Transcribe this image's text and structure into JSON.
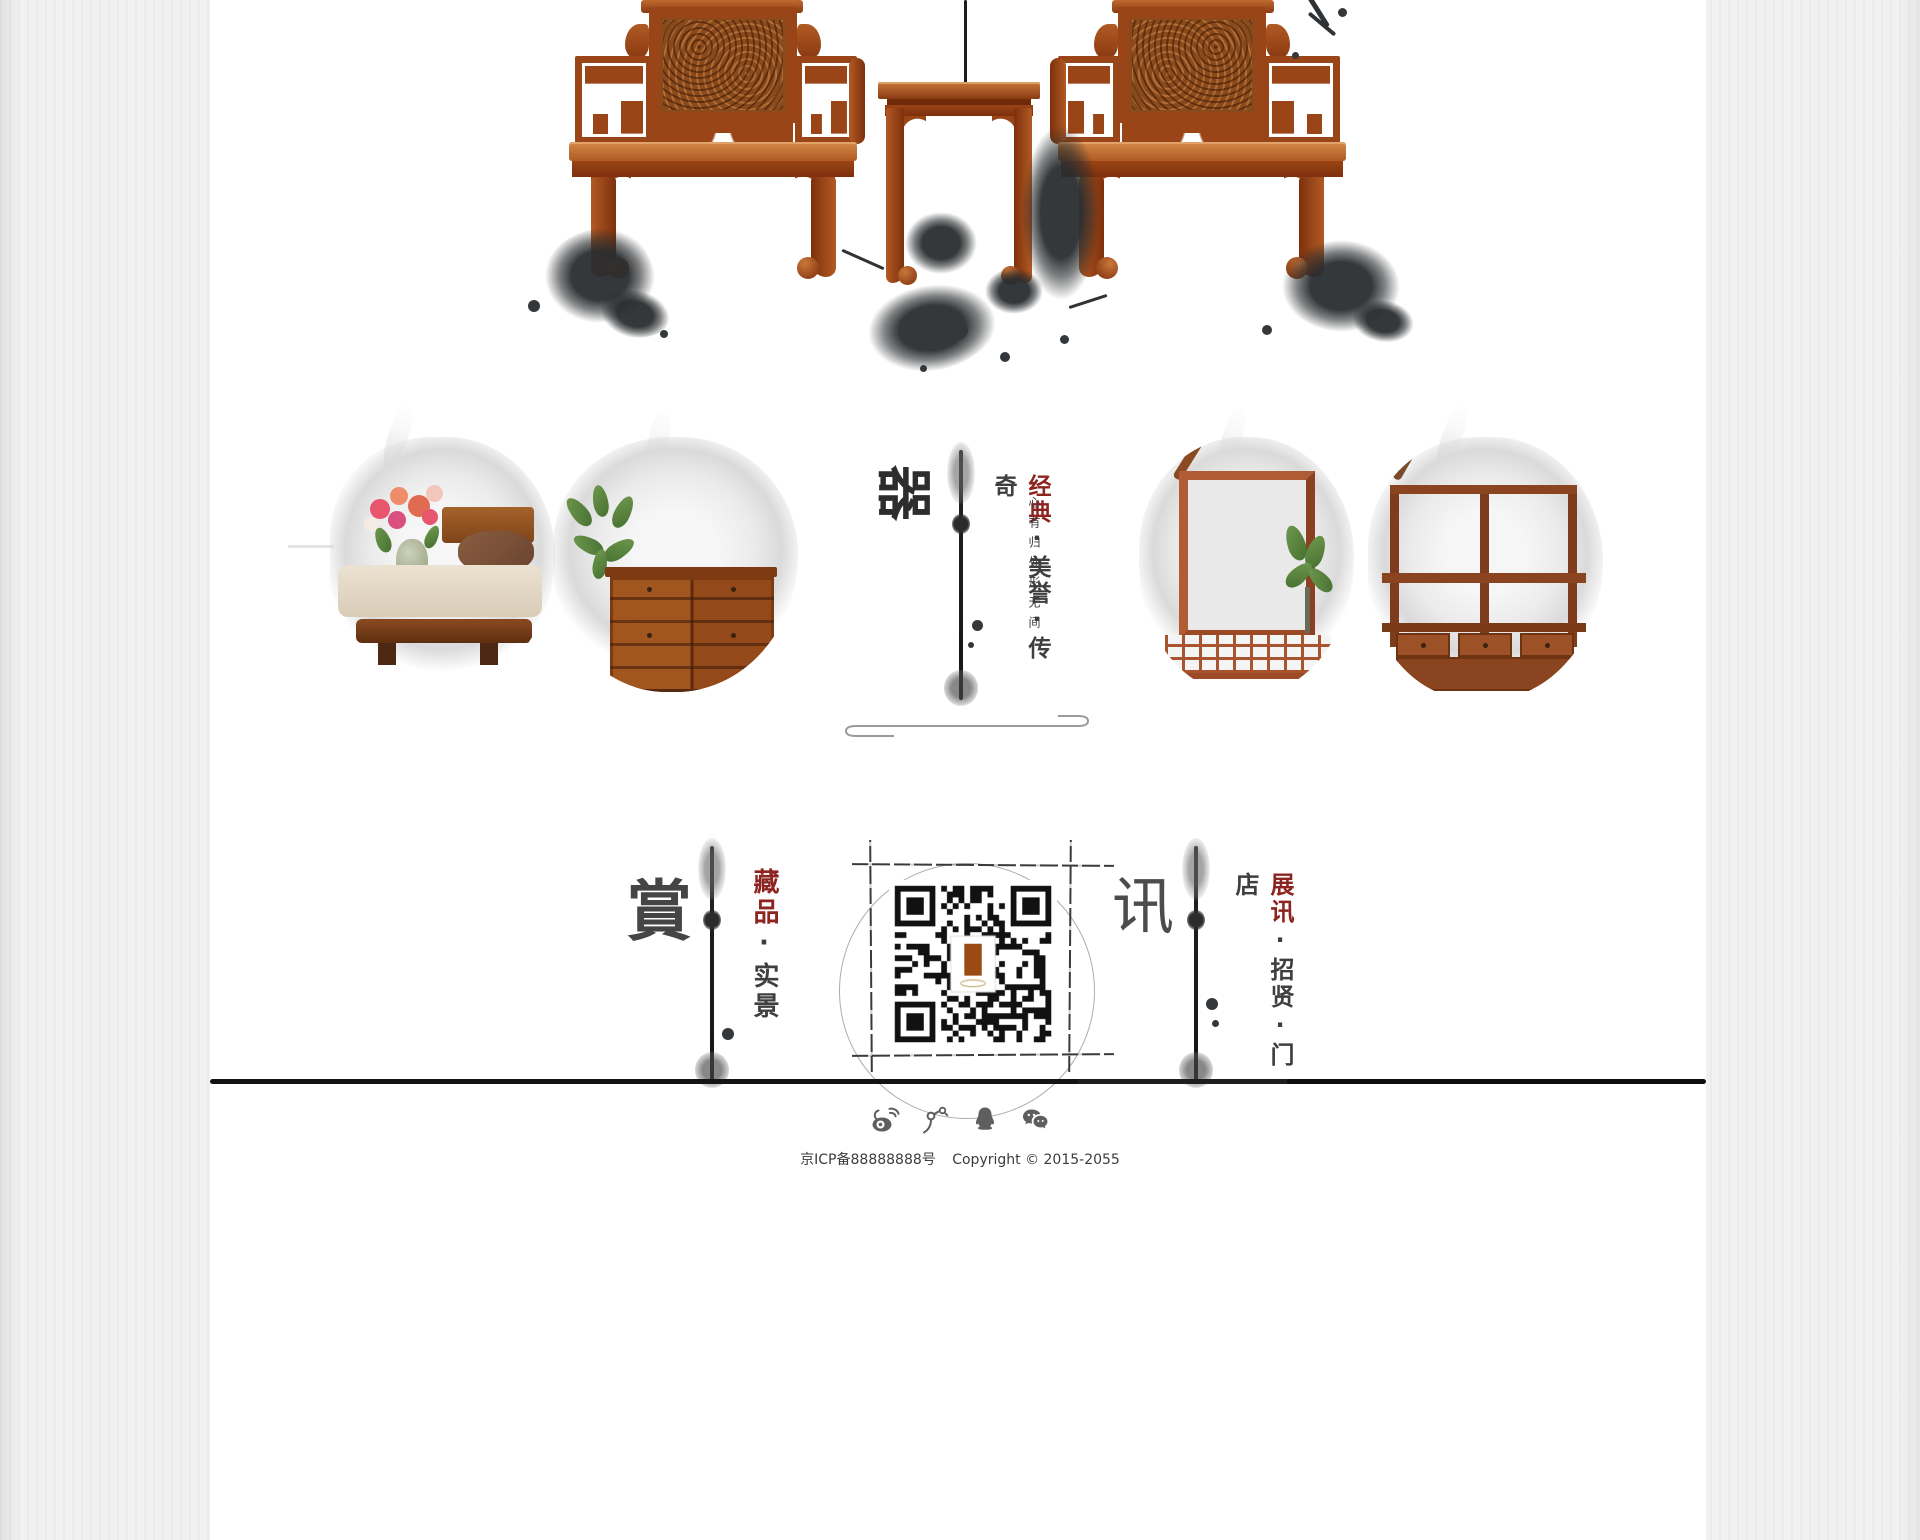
{
  "brand": {
    "mark_glyph": "器",
    "slogan_primary": "经典",
    "slogan_rest": "·美誉·传奇",
    "sub_slogan": "心有归处形无间",
    "accent_color": "#8e2420"
  },
  "nav_sections": {
    "shang": {
      "glyph": "賞",
      "primary": "藏品",
      "rest": "·实景"
    },
    "xun": {
      "glyph": "讯",
      "primary": "展讯",
      "rest": "·招贤·门店"
    }
  },
  "gallery": {
    "items": [
      {
        "name": "bedroom-flower-scene"
      },
      {
        "name": "drawer-cabinet-scene"
      },
      {
        "name": "lattice-frame-scene"
      },
      {
        "name": "display-shelf-scene"
      }
    ]
  },
  "qr": {
    "name": "wechat-qr-code"
  },
  "footer": {
    "social": [
      "weibo",
      "tencent-weibo",
      "qq",
      "wechat"
    ],
    "icp": "京ICP备88888888号",
    "copyright": "Copyright © 2015-2055"
  },
  "colors": {
    "accent_red": "#8e2420",
    "ink": "#2e3133",
    "wood": "#a8501f",
    "text_gray": "#3f3f3f"
  }
}
